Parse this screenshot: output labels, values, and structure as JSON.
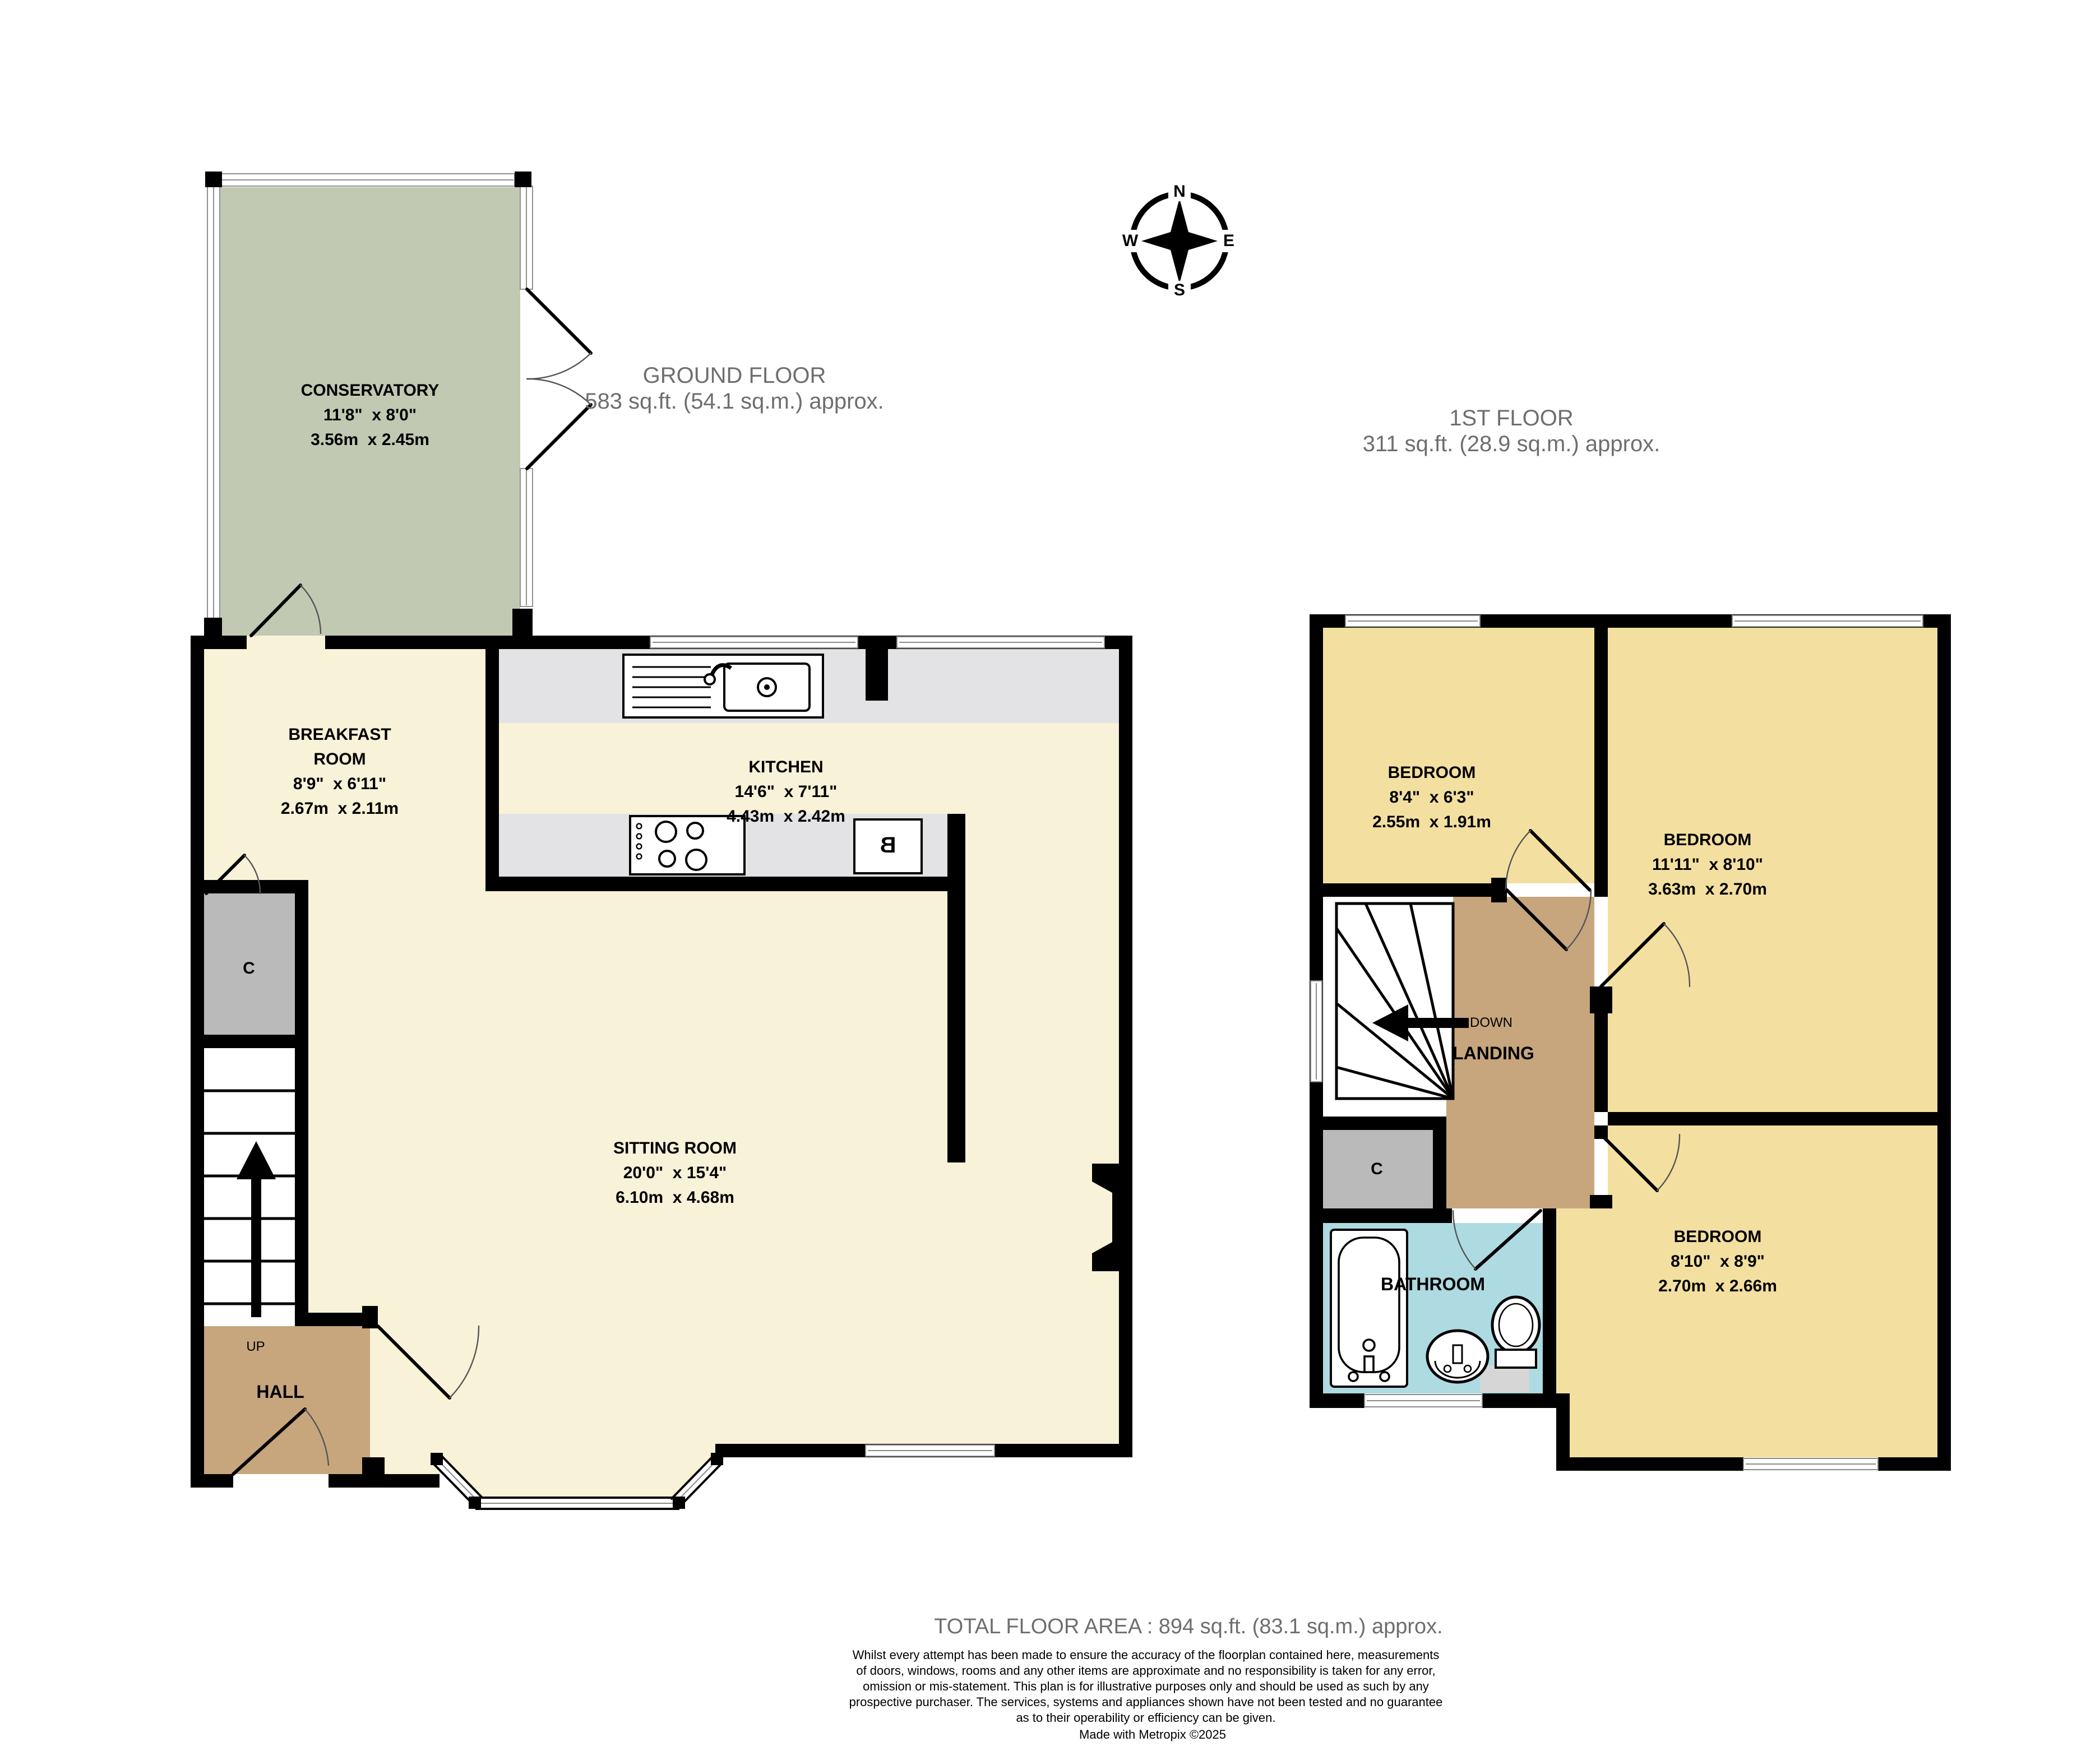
{
  "compass": {
    "north": "N",
    "east": "E",
    "south": "S",
    "west": "W"
  },
  "floors": {
    "ground": {
      "title": "GROUND FLOOR",
      "area": "583 sq.ft. (54.1 sq.m.) approx."
    },
    "first": {
      "title": "1ST FLOOR",
      "area": "311 sq.ft. (28.9 sq.m.) approx."
    }
  },
  "rooms": {
    "conservatory": {
      "name": "CONSERVATORY",
      "imperial": "11'8\"  x 8'0\"",
      "metric": "3.56m  x 2.45m"
    },
    "breakfast": {
      "name1": "BREAKFAST",
      "name2": "ROOM",
      "imperial": "8'9\"  x 6'11\"",
      "metric": "2.67m  x 2.11m"
    },
    "kitchen": {
      "name": "KITCHEN",
      "imperial": "14'6\"  x 7'11\"",
      "metric": "4.43m  x 2.42m"
    },
    "sitting": {
      "name": "SITTING ROOM",
      "imperial": "20'0\"  x 15'4\"",
      "metric": "6.10m  x 4.68m"
    },
    "hall": {
      "name": "HALL",
      "up": "UP"
    },
    "closet_ground": {
      "name": "C"
    },
    "boiler": {
      "name": "B"
    },
    "bedroom_small": {
      "name": "BEDROOM",
      "imperial": "8'4\"  x 6'3\"",
      "metric": "2.55m  x 1.91m"
    },
    "bedroom_right": {
      "name": "BEDROOM",
      "imperial": "11'11\"  x 8'10\"",
      "metric": "3.63m  x 2.70m"
    },
    "bedroom_bottom": {
      "name": "BEDROOM",
      "imperial": "8'10\"  x 8'9\"",
      "metric": "2.70m  x 2.66m"
    },
    "landing": {
      "name": "LANDING",
      "down": "DOWN"
    },
    "bathroom": {
      "name": "BATHROOM"
    },
    "closet_first": {
      "name": "C"
    }
  },
  "footer": {
    "total": "TOTAL FLOOR AREA : 894 sq.ft. (83.1 sq.m.) approx.",
    "disclaimer": "Whilst every attempt has been made to ensure the accuracy of the floorplan contained here, measurements\nof doors, windows, rooms and any other items are approximate and no responsibility is taken for any error,\nomission or mis-statement. This plan is for illustrative purposes only and should be used as such by any\nprospective purchaser. The services, systems and appliances shown have not been tested and no guarantee\nas to their operability or efficiency can be given.",
    "credit": "Made with Metropix ©2025"
  },
  "colors": {
    "wall": "#000000",
    "room_cream": "#F7F2D8",
    "conservatory_sage": "#C1C9B3",
    "bedroom_gold": "#F3E0A0",
    "hall_tan": "#C7A67E",
    "bathroom_blue": "#AEDAE2",
    "closet_gray": "#BABABA",
    "counter_gray": "#E3E3E5",
    "title_gray": "#6E6E6E"
  }
}
